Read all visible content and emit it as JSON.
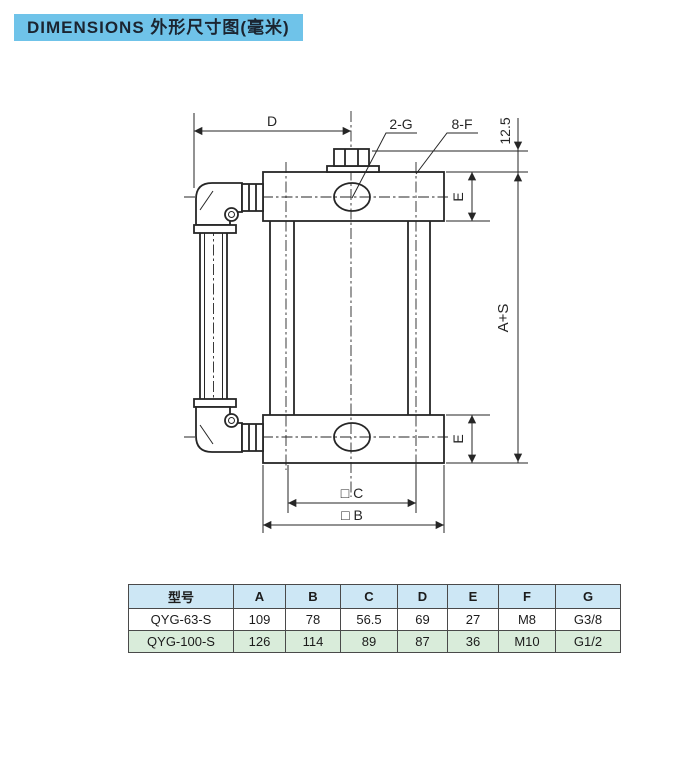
{
  "colors": {
    "banner_bg": "#6fc3e9",
    "banner_text": "#1b2430",
    "table_header_bg": "#cde7f5",
    "table_row_alt_bg": "#d9ecda",
    "table_border": "#4a4a4a",
    "line": "#262626",
    "page_bg": "#ffffff"
  },
  "banner": {
    "title": "DIMENSIONS 外形尺寸图(毫米)"
  },
  "drawing": {
    "dim_d": "D",
    "leader_2g": "2-G",
    "leader_8f": "8-F",
    "dim_12_5": "12.5",
    "dim_e_top": "E",
    "dim_e_bottom": "E",
    "dim_a_plus_s": "A+S",
    "dim_square_c": "□ C",
    "dim_square_b": "□ B"
  },
  "table": {
    "columns": [
      "型号",
      "A",
      "B",
      "C",
      "D",
      "E",
      "F",
      "G"
    ],
    "rows": [
      [
        "QYG-63-S",
        "109",
        "78",
        "56.5",
        "69",
        "27",
        "M8",
        "G3/8"
      ],
      [
        "QYG-100-S",
        "126",
        "114",
        "89",
        "87",
        "36",
        "M10",
        "G1/2"
      ]
    ]
  }
}
